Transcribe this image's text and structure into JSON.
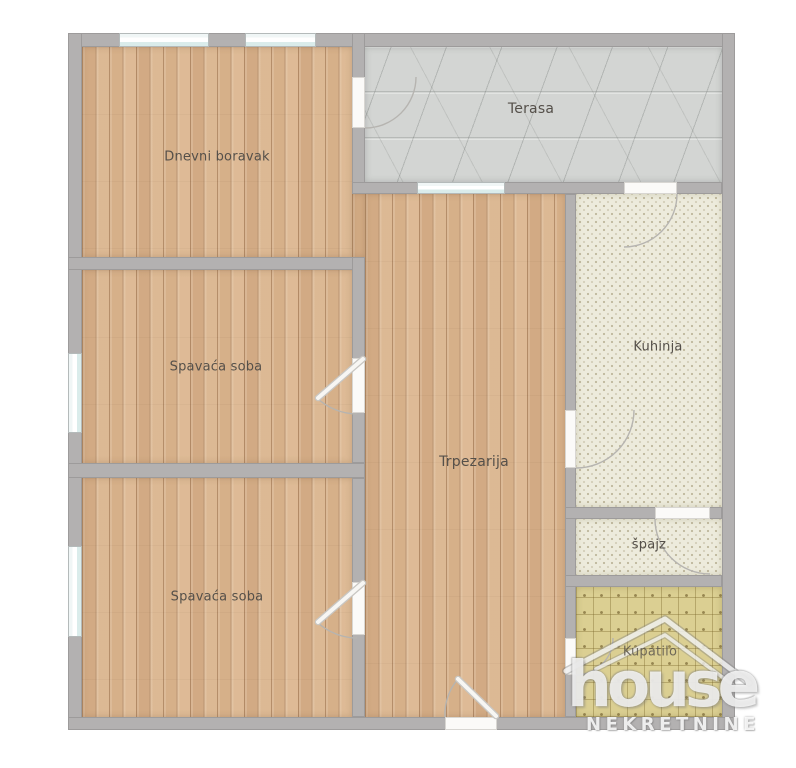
{
  "plan": {
    "rooms": [
      {
        "name": "Dnevni boravak",
        "floor": "wood"
      },
      {
        "name": "Terasa",
        "floor": "stone"
      },
      {
        "name": "Spavaća soba",
        "floor": "wood"
      },
      {
        "name": "Trpezarija",
        "floor": "wood"
      },
      {
        "name": "Kuhinja",
        "floor": "tile-light"
      },
      {
        "name": "špajz",
        "floor": "tile-light"
      },
      {
        "name": "Spavaća soba",
        "floor": "wood"
      },
      {
        "name": "Kupatilo",
        "floor": "tile-dark"
      }
    ],
    "watermark": {
      "brand": "house",
      "subtitle": "NEKRETNINE"
    },
    "colors": {
      "wall": "#b3b1b1",
      "wood_floor": "#d8b38d",
      "terrace_floor": "#d3d5d3",
      "kitchen_tile": "#edebdc",
      "bathroom_tile": "#dbcf92",
      "label_text": "#55504a"
    }
  }
}
